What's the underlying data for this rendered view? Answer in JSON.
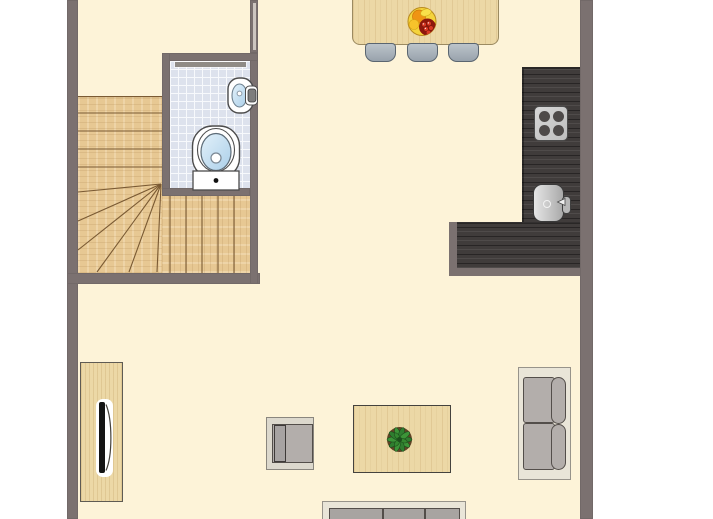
{
  "meta": {
    "kind": "floor-plan-top-view",
    "visible_text": "none"
  },
  "palette": {
    "background": "#ffffff",
    "floor": "#fdf3d8",
    "wall": "#7b7170",
    "wall_stripe": "#ccc5bf",
    "tile": "#dde2ed",
    "tile_line": "#f7f9fc",
    "stair_wood": "#e7c893",
    "stair_tread": "#7a5a33",
    "wood_light": "#ecd8a6",
    "wood_border": "#9b8a61",
    "counter_dark": "#403c3b",
    "plate": "#bfbfbf",
    "burner": "#4e4a49",
    "sink_steel": "#a9a9a9",
    "fixture_outline": "#4c4c4c",
    "basin_blue": "#c9e1f3",
    "chair_fill": "#98a2ac",
    "chair_fill_light": "#bcc4ca",
    "chair_border": "#5a6570",
    "sofa_frame": "#e9e5d8",
    "sofa_frame_border": "#97938a",
    "cushion": "#b3aeab",
    "cushion_dark": "#a8a4a1",
    "cushion_border": "#534e4a",
    "armchair_frame": "#dcd8cd",
    "door_bar": "#8f8b86",
    "plant_green": "#2f7d2f",
    "plant_dark": "#1c4f1c",
    "plant_soil": "#5f4426",
    "fruit_yellow": "#f4d43c",
    "fruit_orange": "#ef9413",
    "fruit_red_dark": "#8e180c",
    "grape_red": "#d93a24",
    "tv_black": "#141414"
  },
  "rooms": [
    "hall-with-staircase",
    "bathroom",
    "open-kitchen",
    "living-dining-room"
  ],
  "inventory": {
    "staircase": {
      "style": "L-shaped with corner winders",
      "upper_tread_lines": 4,
      "winder_lines": 6,
      "lower_tread_lines": 5
    },
    "bathroom": [
      "toilet-with-cistern",
      "wall-hung-washbasin",
      "wall-tap",
      "tiled-floor",
      "sliding-door-bar"
    ],
    "dining_area": [
      "wood-dining-table",
      "fruit-bowl",
      "chair",
      "chair",
      "chair"
    ],
    "kitchen": [
      "l-shaped-dark-counter",
      "cooktop-4-burners",
      "sink",
      "faucet"
    ],
    "living_area": [
      "two-seat-sofa",
      "partial-sofa-bottom-edge",
      "wood-coffee-table",
      "potted-plant",
      "armchair",
      "tv-sideboard",
      "television"
    ]
  }
}
